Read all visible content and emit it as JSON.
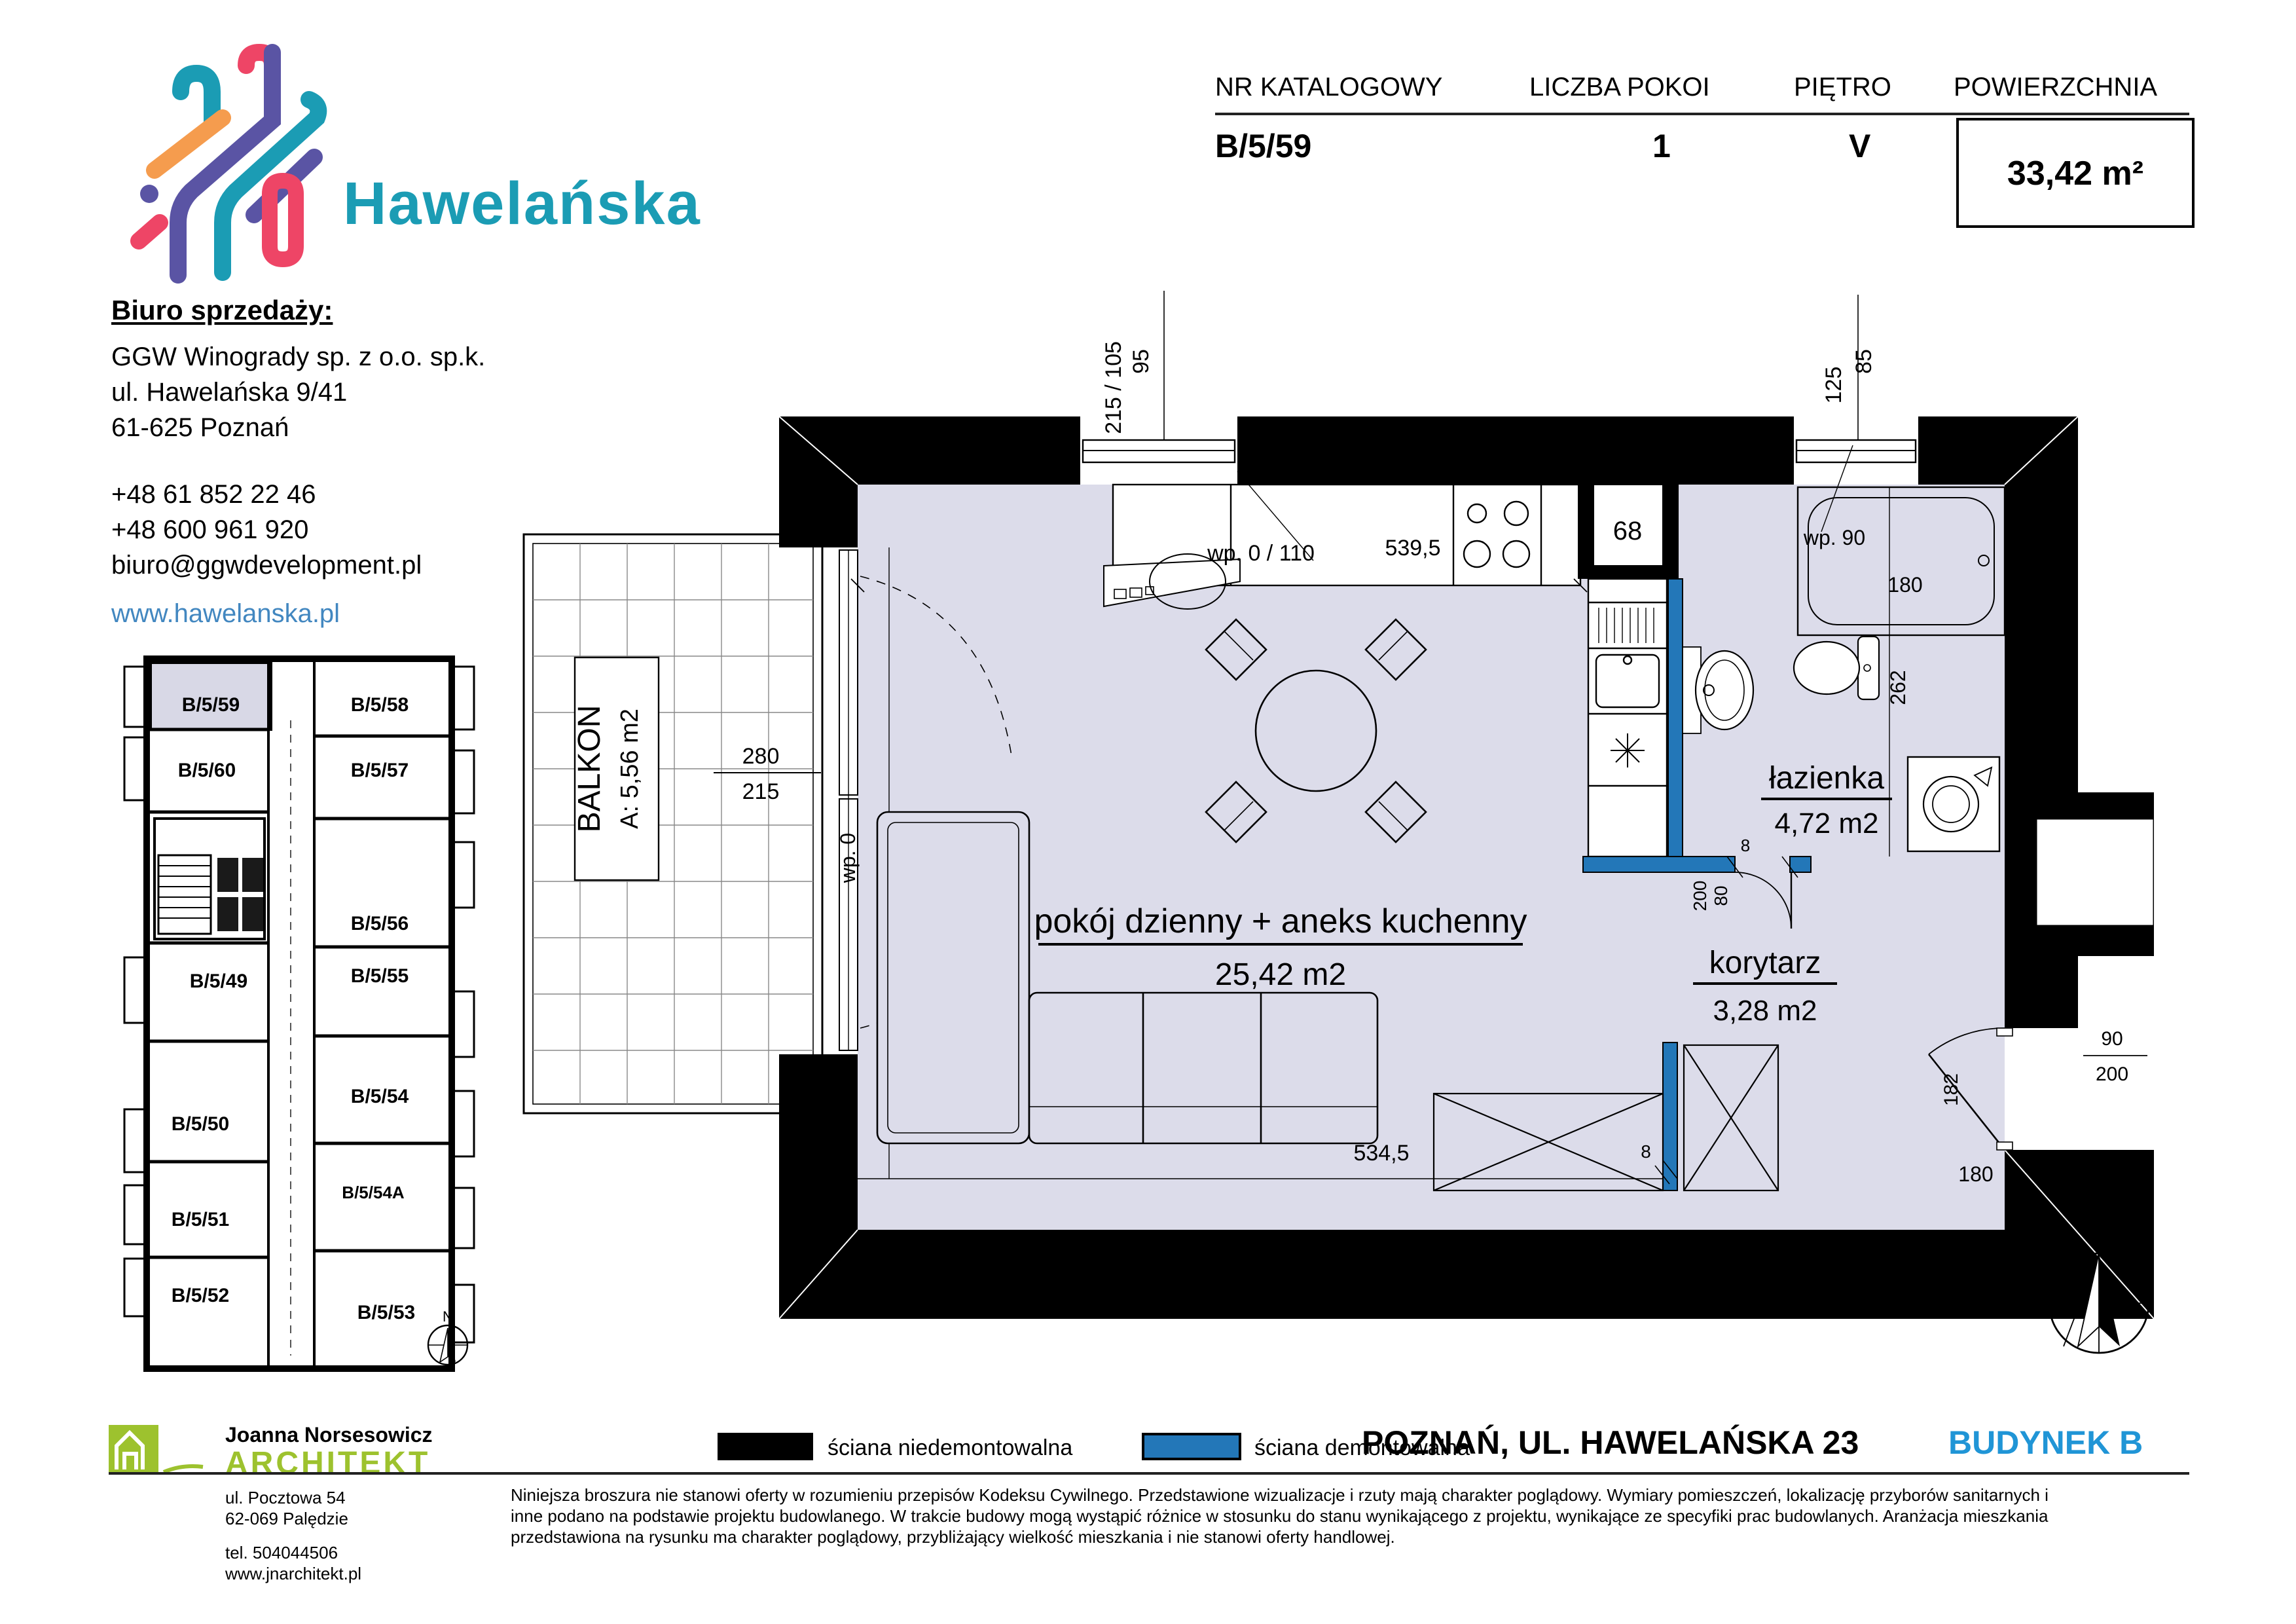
{
  "header": {
    "brand": "Hawelańska",
    "office_heading": "Biuro sprzedaży:",
    "company": "GGW Winogrady sp. z o.o. sp.k.",
    "address_line1": "ul. Hawelańska 9/41",
    "address_line2": "61-625 Poznań",
    "phone1": "+48 61 852 22 46",
    "phone2": "+48 600 961 920",
    "email": "biuro@ggwdevelopment.pl",
    "website": "www.hawelanska.pl"
  },
  "info_table": {
    "col1_label": "NR KATALOGOWY",
    "col1_value": "B/5/59",
    "col2_label": "LICZBA POKOI",
    "col2_value": "1",
    "col3_label": "PIĘTRO",
    "col3_value": "V",
    "col4_label": "POWIERZCHNIA",
    "col4_value": "33,42 m²"
  },
  "mini_plan": {
    "units": [
      "B/5/59",
      "B/5/60",
      "B/5/49",
      "B/5/50",
      "B/5/51",
      "B/5/52",
      "B/5/58",
      "B/5/57",
      "B/5/56",
      "B/5/55",
      "B/5/54",
      "B/5/54A",
      "B/5/53"
    ],
    "compass": "N"
  },
  "plan": {
    "rooms": {
      "living_name": "pokój dzienny + aneks kuchenny",
      "living_area": "25,42 m2",
      "corridor_name": "korytarz",
      "corridor_area": "3,28 m2",
      "bathroom_name": "łazienka",
      "bathroom_area": "4,72 m2",
      "balcony_name": "BALKON",
      "balcony_area": "A: 5,56 m2"
    },
    "dims": {
      "w1_outer": "95",
      "w1_inner": "215 / 105",
      "w1_note": "wp. 0 / 110",
      "room_width_top": "539,5",
      "shaft": "68",
      "w2_outer": "85",
      "w2_inner": "125",
      "w2_note": "wp. 90",
      "tub": "180",
      "wc_depth": "262",
      "balc_door_top": "280",
      "balc_door_bottom": "215",
      "balc_door_note": "wp. 0",
      "room_height": "452",
      "room_width_bottom": "534,5",
      "wall_8": "8",
      "bath_door_h": "200",
      "bath_door_w": "80",
      "bath_wall": "8",
      "entry_height": "182",
      "entry_door_w": "90",
      "entry_door_h": "200",
      "entry_width": "180",
      "compass": "N"
    }
  },
  "legend": {
    "non_demountable": "ściana niedemontowalna",
    "demountable": "ściana demontowalna"
  },
  "footer": {
    "location": "POZNAŃ, UL. HAWELAŃSKA 23",
    "building": "BUDYNEK B",
    "architect_name": "Joanna Norsesowicz",
    "architect_title": "ARCHITEKT",
    "architect_addr1": "ul. Pocztowa 54",
    "architect_addr2": "62-069 Palędzie",
    "architect_tel": "tel. 504044506",
    "architect_web": "www.jnarchitekt.pl",
    "disclaimer1": "Niniejsza broszura nie stanowi oferty w rozumieniu przepisów Kodeksu Cywilnego. Przedstawione wizualizacje i rzuty mają charakter poglądowy. Wymiary pomieszczeń, lokalizację przyborów sanitarnych i",
    "disclaimer2": "inne podano na podstawie projektu budowlanego. W trakcie budowy mogą wystąpić różnice w stosunku do stanu wynikającego z projektu, wynikające ze specyfiki prac budowlanych. Aranżacja mieszkania",
    "disclaimer3": "przedstawiona na rysunku ma charakter poglądowy, przybliżający wielkość mieszkania i nie stanowi oferty handlowej."
  },
  "colors": {
    "teal": "#1b9cb4",
    "wall_blue": "#2377b8",
    "accent_blue": "#2095d6",
    "link_blue": "#4287c0",
    "green": "#9dc22e",
    "floor": "#dcdcea"
  }
}
